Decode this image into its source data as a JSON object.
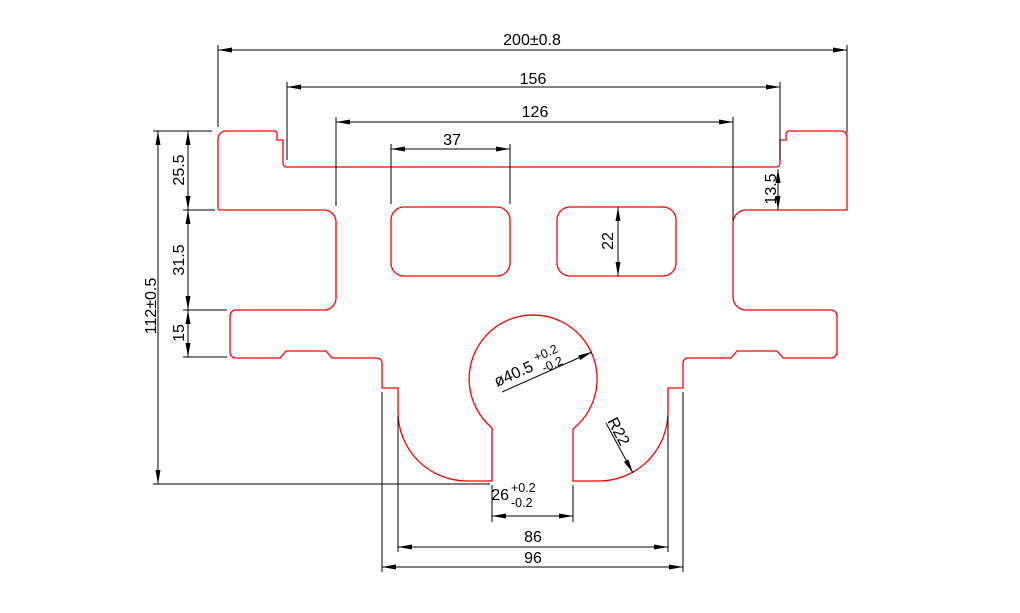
{
  "drawing": {
    "type": "engineering-part-drawing",
    "labels": {
      "width_total": "200±0.8",
      "width_upper": "156",
      "width_waist": "126",
      "hole_width": "37",
      "height_total": "112±0.5",
      "height_upper": "25.5",
      "height_notch": "31.5",
      "height_tab": "15",
      "height_step_right": "13.5",
      "hole_height": "22",
      "circle_dia": "ø40.5",
      "circle_dia_tol_plus": "+0.2",
      "circle_dia_tol_minus": "-0.2",
      "fillet_radius": "R22",
      "slot_width": "26",
      "slot_width_tol_plus": "+0.2",
      "slot_width_tol_minus": "-0.2",
      "slot_outer_width": "86",
      "base_width": "96"
    },
    "colors": {
      "part_outline": "#ff0000",
      "dimension_lines": "#000000",
      "background": "#ffffff"
    }
  }
}
